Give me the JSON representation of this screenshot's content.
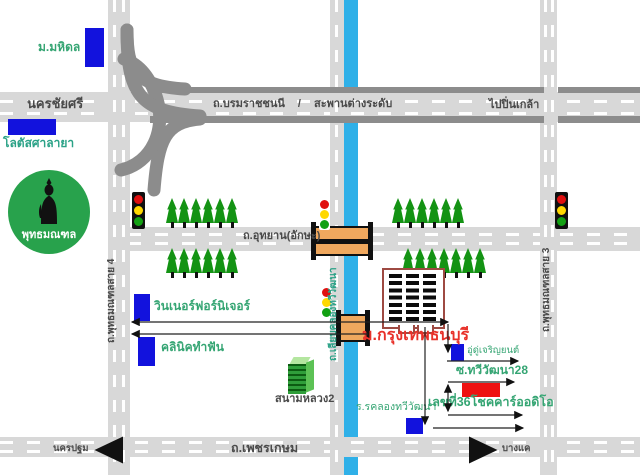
{
  "map": {
    "colors": {
      "road_gray": "#d8d8d8",
      "highway_edge_gray": "#8c8c8c",
      "canal_blue": "#2fb0e8",
      "marker_blue": "#1212dd",
      "marker_red": "#ee1111",
      "label_green": "#35a573",
      "road_label_dark": "#4a4a4a",
      "destination_red": "#e8312a",
      "park_green": "#28a24c",
      "tree_green": "#149314",
      "bridge_orange": "#f0a85e"
    },
    "top_left": {
      "mahidol_university": "ม.มหิดล",
      "lotus_salaya": "โลตัสศาลายา"
    },
    "roads": {
      "nakhon_chai_si": "นครชัยศรี",
      "borommaratchachonnani": "ถ.บรมราชชนนี",
      "separator": "/",
      "overpass": "สะพานต่างระดับ",
      "to_pin_klao": "ไปปิ่นเกล้า",
      "utthayan_aksa": "ถ.อุทยาน(อักษะ)",
      "phutthamonthon_sai4": "ถ.พุทธมณฑลสาย 4",
      "phutthamonthon_sai3": "ถ.พุทธมณฑลสาย 3",
      "liap_khlong_thawi_watthana": "ถ.เลียบคลองทวีวัฒนา",
      "phet_kasem": "ถ.เพชรเกษม",
      "west_nakhon_pathom": "นครปฐม",
      "east_bang_khae": "บางแค"
    },
    "park": {
      "phutthamonthon": "พุทธมณฑล"
    },
    "destination": {
      "bangkok_thonburi_university": "ม.กรุงเทพธนบุรี"
    },
    "places": {
      "winner_furniture": "วินเนอร์ฟอร์นิเจอร์",
      "dental_clinic": "คลินิคทำฟัน",
      "sanam_luang_2": "สนามหลวง2",
      "charoenyon_garage": "อู่ดู่เจริญยนต์",
      "soi_thawi_watthana_28": "ซ.ทวีวัฒนา28",
      "address_36_chok_car_audio": "เลขที่36โชคคาร์ออดิโอ",
      "khlong_thawi_watthana_school": "ร.รคลองทวีวัฒนา"
    },
    "icons": {
      "traffic_light": "traffic-light-icon",
      "tree": "tree-icon",
      "buddha_statue": "buddha-statue-icon",
      "canal_bridge": "bridge-icon",
      "university_building": "university-building-icon",
      "green_building": "sanam-luang-building-icon"
    }
  }
}
